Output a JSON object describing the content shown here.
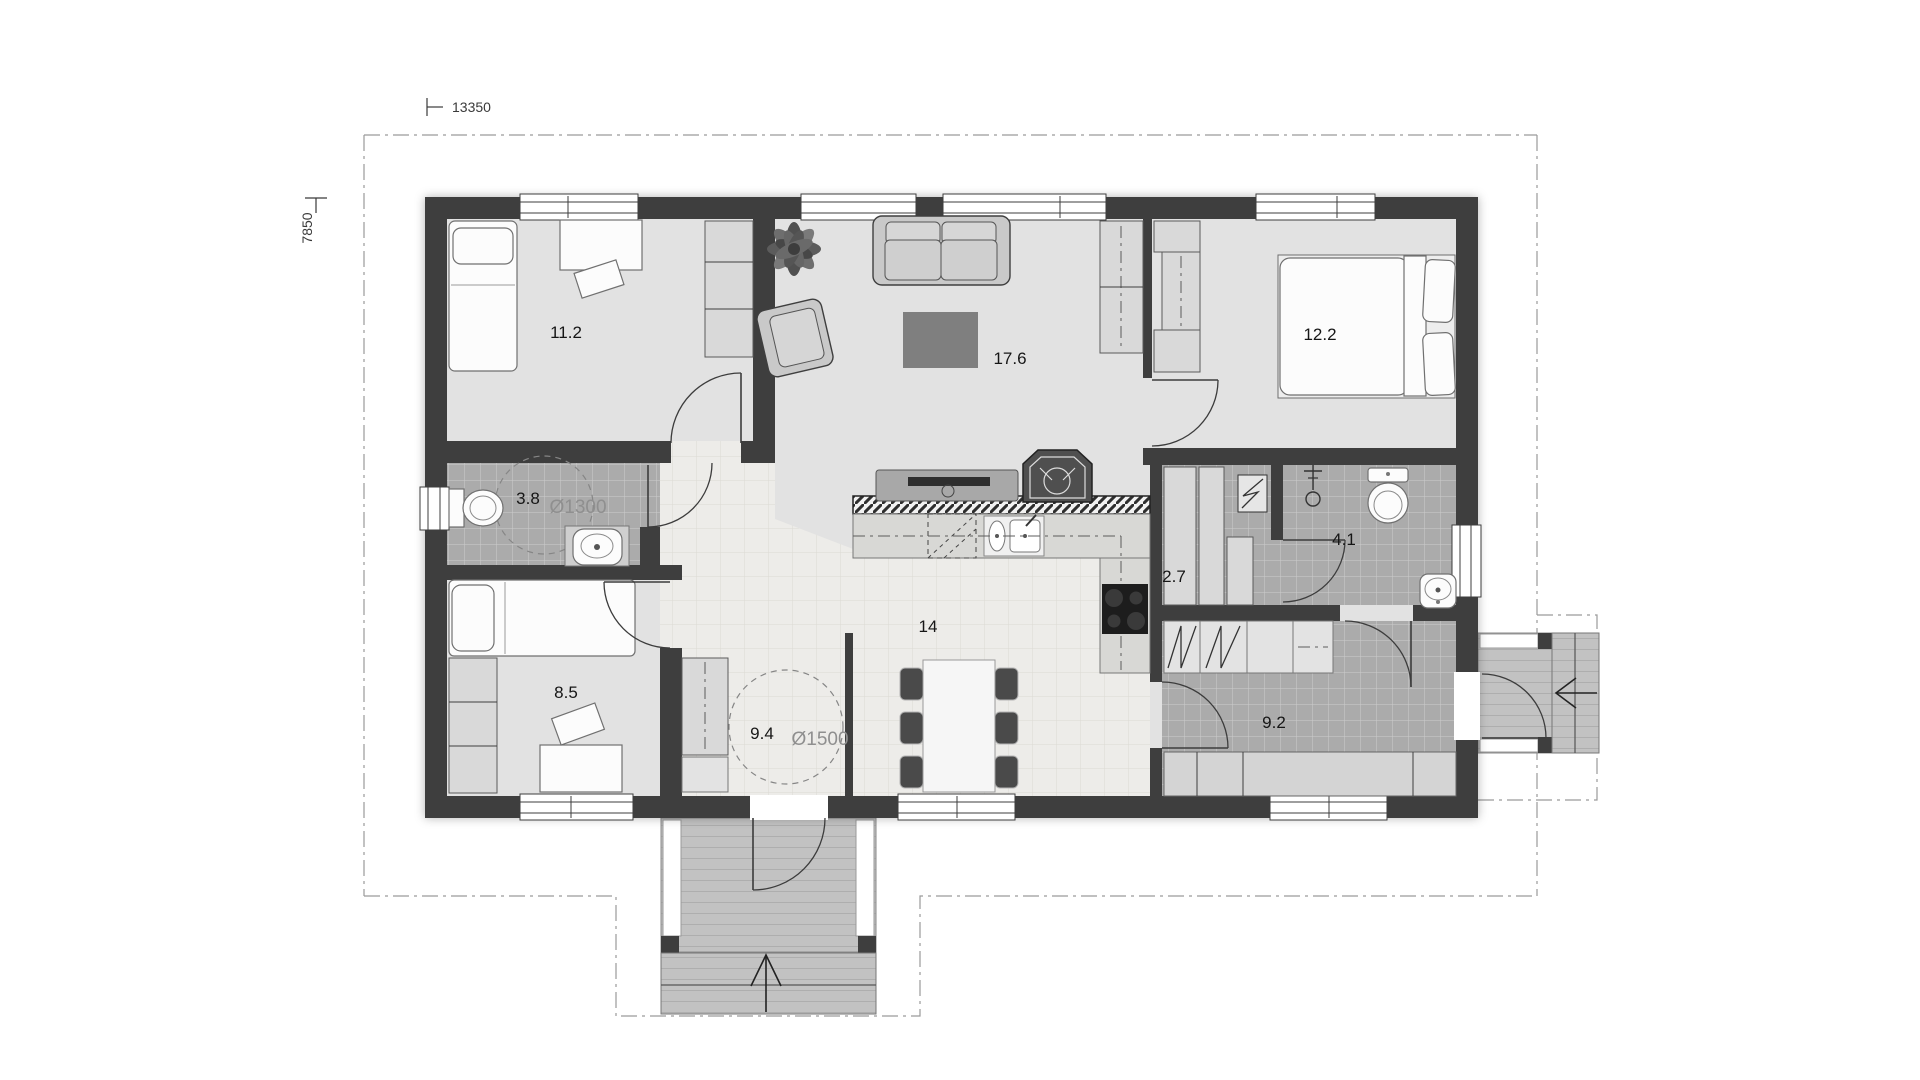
{
  "drawing": {
    "type": "floor-plan",
    "dimensions": {
      "width_label": "13350",
      "height_label": "7850"
    },
    "rooms": {
      "bedroom1": {
        "area": "11.2"
      },
      "living": {
        "area": "17.6"
      },
      "bedroom2": {
        "area": "12.2"
      },
      "bathroom1": {
        "area": "3.8",
        "clearance": "Ø1300"
      },
      "closet": {
        "area": "2.7"
      },
      "bathroom2": {
        "area": "4.1"
      },
      "bedroom3": {
        "area": "8.5"
      },
      "hall": {
        "area": "9.4",
        "clearance": "Ø1500"
      },
      "kitchen_dining": {
        "area": "14"
      },
      "utility": {
        "area": "9.2"
      }
    },
    "colors": {
      "wall": "#3e3e3e",
      "room_floor": "#e2e2e2",
      "tile_dark": "#ababab",
      "tile_light": "#edece9",
      "deck": "#c2c2c2",
      "label_dark": "#161616",
      "label_gray": "#8f8f8f"
    }
  }
}
